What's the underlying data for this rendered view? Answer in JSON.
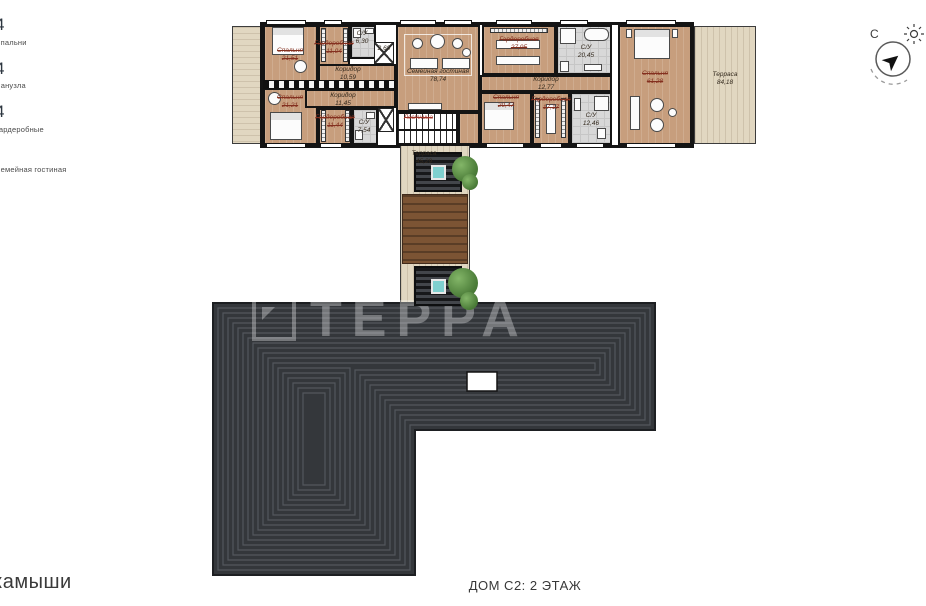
{
  "palette": {
    "wood_floor": "#c79e7d",
    "terrace": "#e1d7c1",
    "bath_tile": "#d8d8d8",
    "wall": "#141414",
    "roof_dark": "#34373b",
    "roof_line": "#53575d",
    "deck_wood": "#7c5434",
    "glass_teal": "#7fd0cf",
    "legend_accent": "#a9d9ea",
    "revision_red": "#84301f"
  },
  "legend": {
    "items": [
      {
        "count": "4",
        "label": "Спальни"
      },
      {
        "count": "4",
        "label": "Санузла"
      },
      {
        "count": "4",
        "label": "Гардеробные"
      },
      {
        "count": "",
        "label": "Семейная гостиная"
      }
    ]
  },
  "rooms": {
    "bedroom_tl": {
      "name": "Спальня",
      "area": "21,51"
    },
    "bedroom_bl": {
      "name": "Спальня",
      "area": "21,21"
    },
    "wardrobe_t": {
      "name": "Гардеробная",
      "area": "11,04"
    },
    "wardrobe_b": {
      "name": "Гардеробная",
      "area": "11,44"
    },
    "corridor_t": {
      "name": "Коридор",
      "area": "10,59"
    },
    "corridor_b": {
      "name": "Коридор",
      "area": "11,45"
    },
    "wc_t": {
      "name": "С/У",
      "area": "6,30"
    },
    "wc_b": {
      "name": "С/У",
      "area": "7,54"
    },
    "closet": {
      "name": "",
      "area": "2,69"
    },
    "family": {
      "name": "Семейная гостиная",
      "area": "78,74"
    },
    "stairs": {
      "name": "Лестница",
      "area": ""
    },
    "wardrobe_master": {
      "name": "Гардеробная",
      "area": "27,95"
    },
    "bath_master": {
      "name": "С/У",
      "area": "20,45"
    },
    "corridor_r": {
      "name": "Коридор",
      "area": "12,77"
    },
    "bedroom_bm": {
      "name": "Спальня",
      "area": "20,47"
    },
    "wardrobe_bm": {
      "name": "Гардеробная",
      "area": "17,17"
    },
    "wc_bm": {
      "name": "С/У",
      "area": "12,46"
    },
    "bedroom_master": {
      "name": "Спальня",
      "area": "61,28"
    },
    "terrace_right": {
      "name": "Терраса",
      "area": "84,18"
    },
    "terrace_center": {
      "name": "Терраса",
      "area": "45,29"
    }
  },
  "compass": {
    "north": "С"
  },
  "watermark": "ТЕРРА",
  "footer": {
    "project": "камыши",
    "plan_title": "ДОМ С2: 2 ЭТАЖ"
  }
}
